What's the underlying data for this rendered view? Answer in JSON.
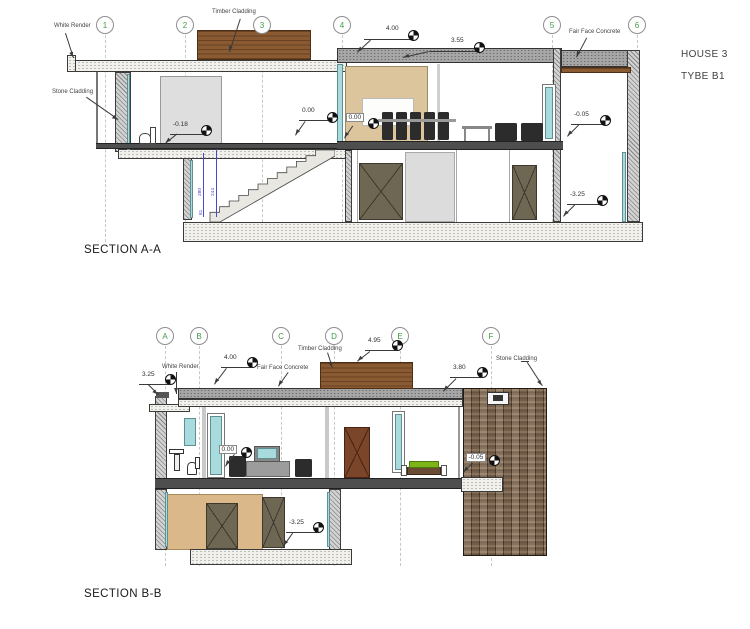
{
  "drawing": {
    "house_label": "HOUSE 3",
    "type_label": "TYBE B1"
  },
  "section_a": {
    "title": "SECTION A-A",
    "grids": [
      "1",
      "2",
      "3",
      "4",
      "5",
      "6"
    ],
    "materials": {
      "white_render": "White Render",
      "timber_cladding": "Timber Cladding",
      "stone_cladding": "Stone Cladding",
      "fair_face_concrete": "Fair Face Concrete"
    },
    "levels": {
      "roof": "4.00",
      "roof2": "3.55",
      "ground_a": "0.00",
      "ground_b": "0.00",
      "wc": "-0.18",
      "terrace": "-0.05",
      "basement": "-3.25"
    },
    "stair_dims": [
      "280",
      "244",
      "81"
    ]
  },
  "section_b": {
    "title": "SECTION B-B",
    "grids": [
      "A",
      "B",
      "C",
      "D",
      "E",
      "F"
    ],
    "materials": {
      "white_render": "White Render",
      "fair_face_concrete": "Fair Face Concrete",
      "timber_cladding": "Timber Cladding",
      "stone_cladding": "Stone Cladding"
    },
    "levels": {
      "parapet": "3.25",
      "roof": "4.00",
      "roof_high": "4.95",
      "roof_low": "3.80",
      "ground": "0.00",
      "terrace": "-0.05",
      "basement": "-3.25"
    }
  },
  "colors": {
    "grid_label": "#3f9b45",
    "timber": "#8a5a33",
    "concrete": "#a6a6a6",
    "stone": "#63503f",
    "glass": "#a8dbdd",
    "dim_blue": "#4848c8"
  }
}
